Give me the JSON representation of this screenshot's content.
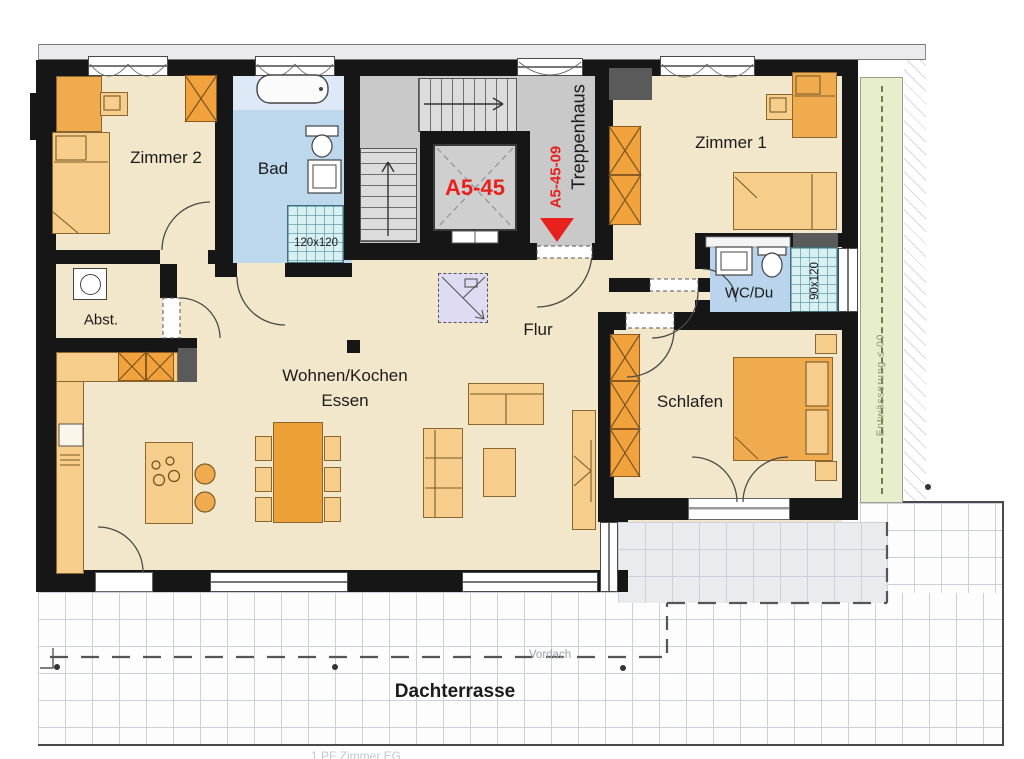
{
  "plan": {
    "rooms": {
      "zimmer2": "Zimmer 2",
      "bad": "Bad",
      "zimmer1": "Zimmer 1",
      "abstellraum": "Abst.",
      "flur": "Flur",
      "wohnen_kochen": "Wohnen/Kochen",
      "essen": "Essen",
      "wc_du": "WC/Du",
      "schlafen": "Schlafen",
      "treppenhaus": "Treppenhaus",
      "dachterrasse": "Dachterrasse",
      "vordach": "Vordach"
    },
    "labels": {
      "elevator_unit": "A5-45",
      "unit_entrance": "A5-45-09",
      "shower_bad_dim": "120x120",
      "shower_wc_dim": "90x120",
      "green_strip_note": "Entwässerung ≤ 00",
      "footer_note": "1 PF Zimmer EG"
    },
    "colors": {
      "wall": "#161616",
      "floor": "#f2e7ca",
      "bath_floor": "#bdd7ed",
      "stair_floor": "#c9c9c9",
      "furniture_orange": "#f0ab4e",
      "furniture_light": "#f6cd8a",
      "accent_red": "#e8211d",
      "green_strip": "#e6eecb",
      "tile_teal": "#d9f0f2",
      "shaft_purple": "#dedbf2"
    }
  }
}
